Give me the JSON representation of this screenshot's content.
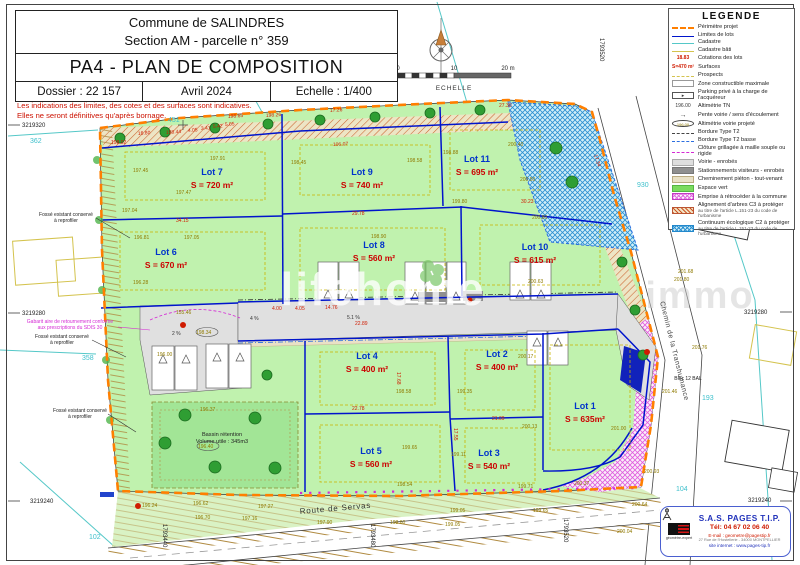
{
  "title_block": {
    "line1": "Commune de SALINDRES",
    "line2": "Section AM - parcelle n° 359",
    "main_title": "PA4 - PLAN DE COMPOSITION",
    "dossier": "Dossier : 22 157",
    "date": "Avril 2024",
    "echelle": "Echelle : 1/400"
  },
  "disclaimer": {
    "line1": "Les indications des limites, des cotes et des surfaces sont indicatives.",
    "line2": "Elles ne seront définitives qu'après bornage."
  },
  "scale_bar": {
    "t0": "0",
    "t10": "10",
    "t20": "20 m",
    "label": "ECHELLE"
  },
  "legend": {
    "title": "LEGENDE",
    "entries": [
      {
        "symbol": "line-orange-dash",
        "label": "Périmètre projet"
      },
      {
        "symbol": "line-blue",
        "label": "Limites de lots"
      },
      {
        "symbol": "line-cyan",
        "label": "Cadastre"
      },
      {
        "symbol": "line-yellow",
        "label": "Cadastre bâti"
      },
      {
        "symbol": "text-red",
        "sample": "18.83",
        "label": "Cotations des lots"
      },
      {
        "symbol": "text-red",
        "sample": "S=470 m²",
        "label": "Surfaces"
      },
      {
        "symbol": "line-yellow-thin",
        "label": "Prospects"
      },
      {
        "symbol": "box-white",
        "label": "Zone constructible maximale"
      },
      {
        "symbol": "box-parking",
        "sample": "▸",
        "label": "Parking privé à la charge de l'acquéreur"
      },
      {
        "symbol": "text-black",
        "sample": "196.00",
        "label": "Altimétrie TN"
      },
      {
        "symbol": "arrow",
        "sample": "→",
        "label": "Pente voirie / sens d'écoulement"
      },
      {
        "symbol": "ellipse",
        "sample": "196.00",
        "label": "Altimétrie voirie projeté"
      },
      {
        "symbol": "line-dark-dash",
        "label": "Bordure Type T2"
      },
      {
        "symbol": "line-blue-dash",
        "label": "Bordure Type T2 basse"
      },
      {
        "symbol": "line-magenta",
        "label": "Clôture grillagée à maille souple ou rigide"
      },
      {
        "symbol": "box-gray-light",
        "label": "Voirie - enrobés"
      },
      {
        "symbol": "box-gray-dark",
        "label": "Stationnements visiteurs - enrobés"
      },
      {
        "symbol": "box-beige",
        "label": "Cheminement piéton - tout-venant"
      },
      {
        "symbol": "box-green",
        "label": "Espace vert"
      },
      {
        "symbol": "hatch-magenta",
        "label": "Emprise à rétrocéder à la commune"
      },
      {
        "symbol": "hatch-red",
        "label": "Alignement d'arbres C3 à protéger",
        "sub": "au titre de l'article L.151-23 du code de l'urbanisme"
      },
      {
        "symbol": "hatch-blue",
        "label": "Continuum écologique C2 à protéger",
        "sub": "au titre de l'article L.151-23 du code de l'urbanisme"
      }
    ]
  },
  "lots": [
    {
      "name": "Lot 1",
      "area": "S = 635m²",
      "x": 585,
      "y": 409
    },
    {
      "name": "Lot 2",
      "area": "S = 400 m²",
      "x": 497,
      "y": 357
    },
    {
      "name": "Lot 3",
      "area": "S = 540 m²",
      "x": 489,
      "y": 456
    },
    {
      "name": "Lot 4",
      "area": "S = 400 m²",
      "x": 367,
      "y": 359
    },
    {
      "name": "Lot 5",
      "area": "S = 560 m²",
      "x": 371,
      "y": 454
    },
    {
      "name": "Lot 6",
      "area": "S = 670 m²",
      "x": 166,
      "y": 255
    },
    {
      "name": "Lot 7",
      "area": "S = 720 m²",
      "x": 212,
      "y": 175
    },
    {
      "name": "Lot 8",
      "area": "S = 560 m²",
      "x": 374,
      "y": 248
    },
    {
      "name": "Lot 9",
      "area": "S = 740 m²",
      "x": 362,
      "y": 175
    },
    {
      "name": "Lot 10",
      "area": "S = 615 m²",
      "x": 535,
      "y": 250
    },
    {
      "name": "Lot 11",
      "area": "S = 695 m²",
      "x": 477,
      "y": 162
    }
  ],
  "streets": {
    "servas": "Route de Servas",
    "transhumance": "Chemin de la Transhumance"
  },
  "basin": {
    "line1": "Bassin rétention",
    "line2": "Volume utile : 345m3"
  },
  "watermark": {
    "main": "lifehome",
    "secondary": "immo"
  },
  "notes": [
    {
      "l1": "Fossé existant conservé",
      "l2": "à reprofiler",
      "x": 66,
      "y": 216,
      "c": "k"
    },
    {
      "l1": "Gabarit aire de retournement conforme",
      "l2": "aux prescriptions du SDIS 30",
      "x": 70,
      "y": 323,
      "c": "m"
    },
    {
      "l1": "Fossé existant conservé",
      "l2": "à reprofiler",
      "x": 62,
      "y": 338,
      "c": "k"
    },
    {
      "l1": "Fossé existant conservé",
      "l2": "à reprofiler",
      "x": 80,
      "y": 412,
      "c": "k"
    },
    {
      "l1": "Bloc 12 BAL",
      "l2": "",
      "x": 688,
      "y": 380,
      "c": "k"
    }
  ],
  "parcels": [
    [
      "362",
      30,
      143
    ],
    [
      "451",
      168,
      122
    ],
    [
      "930",
      637,
      187
    ],
    [
      "358",
      82,
      360
    ],
    [
      "193",
      702,
      400
    ],
    [
      "104",
      676,
      491
    ],
    [
      "102",
      89,
      539
    ]
  ],
  "coordinates": [
    [
      "3219320",
      22,
      127,
      0
    ],
    [
      "3219280",
      22,
      315,
      0
    ],
    [
      "3219240",
      30,
      503,
      0
    ],
    [
      "3219280",
      744,
      314,
      0
    ],
    [
      "3219240",
      748,
      502,
      0
    ],
    [
      "1793520",
      600,
      38,
      90
    ],
    [
      "1793440",
      163,
      524,
      90
    ],
    [
      "1793480",
      371,
      524,
      90
    ],
    [
      "1793520",
      564,
      519,
      90
    ]
  ],
  "annotation_colors": {
    "o": "#8f7a00",
    "r": "#cf1b00",
    "k": "#333333",
    "c": "#3fc0cc",
    "m": "#d429d4"
  },
  "annotations": [
    [
      "198.02",
      111,
      144,
      "r"
    ],
    [
      "16.80",
      138,
      135,
      "r",
      -4
    ],
    [
      "198.44",
      166,
      134,
      "r",
      -4
    ],
    [
      "4.05",
      188,
      132,
      "r",
      -4
    ],
    [
      "3.41",
      201,
      130,
      "r",
      -4
    ],
    [
      "5.42",
      213,
      128,
      "r",
      -4
    ],
    [
      "5.05",
      225,
      126,
      "r",
      -4
    ],
    [
      "198.65",
      228,
      118,
      "r",
      -4
    ],
    [
      "198.26",
      266,
      117,
      "r",
      -4
    ],
    [
      "17.26",
      330,
      112,
      "r",
      -4
    ],
    [
      "106.07",
      333,
      146,
      "r",
      -3
    ],
    [
      "27.30",
      499,
      107,
      "r"
    ],
    [
      "17.34",
      594,
      155,
      "r",
      72
    ],
    [
      "34.15",
      176,
      222,
      "r"
    ],
    [
      "29.78",
      352,
      215,
      "r"
    ],
    [
      "30.23",
      521,
      203,
      "r"
    ],
    [
      "22.78",
      352,
      410,
      "r"
    ],
    [
      "21.09",
      492,
      420,
      "r"
    ],
    [
      "4.00",
      272,
      310,
      "r"
    ],
    [
      "4.05",
      295,
      310,
      "r"
    ],
    [
      "14.76",
      325,
      309,
      "r"
    ],
    [
      "22.89",
      355,
      325,
      "r"
    ],
    [
      "17.68",
      397,
      372,
      "r",
      90
    ],
    [
      "17.55",
      454,
      428,
      "r",
      90
    ],
    [
      "197.45",
      133,
      172,
      "o"
    ],
    [
      "197.91",
      210,
      160,
      "o"
    ],
    [
      "197.47",
      176,
      194,
      "o"
    ],
    [
      "197.04",
      122,
      212,
      "o"
    ],
    [
      "196.81",
      134,
      239,
      "o"
    ],
    [
      "197.05",
      184,
      239,
      "o"
    ],
    [
      "196.28",
      133,
      284,
      "o"
    ],
    [
      "198.45",
      291,
      164,
      "o"
    ],
    [
      "198.58",
      407,
      162,
      "o"
    ],
    [
      "198.88",
      443,
      154,
      "o"
    ],
    [
      "200.40",
      508,
      146,
      "o"
    ],
    [
      "200.50",
      520,
      181,
      "o"
    ],
    [
      "199.80",
      452,
      203,
      "o"
    ],
    [
      "198.90",
      371,
      238,
      "o"
    ],
    [
      "200.80",
      532,
      219,
      "o"
    ],
    [
      "200.63",
      528,
      283,
      "o"
    ],
    [
      "200.17",
      518,
      358,
      "o"
    ],
    [
      "199.35",
      457,
      393,
      "o"
    ],
    [
      "198.58",
      396,
      393,
      "o"
    ],
    [
      "200.13",
      522,
      428,
      "o"
    ],
    [
      "199.65",
      402,
      449,
      "o"
    ],
    [
      "199.11",
      451,
      456,
      "o"
    ],
    [
      "198.54",
      397,
      486,
      "o"
    ],
    [
      "199.71",
      518,
      488,
      "o"
    ],
    [
      "201.76",
      692,
      349,
      "o"
    ],
    [
      "201.46",
      662,
      393,
      "o"
    ],
    [
      "201.00",
      611,
      430,
      "o"
    ],
    [
      "200.93",
      644,
      473,
      "o"
    ],
    [
      "200.37",
      574,
      485,
      "o"
    ],
    [
      "200.64",
      632,
      506,
      "o"
    ],
    [
      "196.37",
      200,
      411,
      "o"
    ],
    [
      "196.24",
      142,
      507,
      "o"
    ],
    [
      "196.62",
      193,
      505,
      "o"
    ],
    [
      "197.27",
      258,
      508,
      "o"
    ],
    [
      "196.70",
      195,
      519,
      "o"
    ],
    [
      "197.16",
      242,
      520,
      "o"
    ],
    [
      "197.90",
      317,
      524,
      "o"
    ],
    [
      "199.05",
      450,
      512,
      "o"
    ],
    [
      "199.65",
      533,
      512,
      "o"
    ],
    [
      "198.60",
      390,
      524,
      "o"
    ],
    [
      "199.05",
      445,
      526,
      "o"
    ],
    [
      "200.04",
      617,
      533,
      "o"
    ],
    [
      "198.34",
      196,
      334,
      "o"
    ],
    [
      "196.00",
      157,
      356,
      "o"
    ],
    [
      "196.40",
      198,
      448,
      "o"
    ],
    [
      "201.68",
      678,
      273,
      "o"
    ],
    [
      "201.80",
      674,
      281,
      "o"
    ],
    [
      "155.46",
      176,
      314,
      "o"
    ],
    [
      "2 %",
      172,
      335,
      "k"
    ],
    [
      "4 %",
      250,
      320,
      "k"
    ],
    [
      "5.1 %",
      347,
      319,
      "k"
    ]
  ],
  "company": {
    "name": "S.A.S. PAGES T.I.P.",
    "tel": "Tél: 04 67 02 06 40",
    "email": "E-mail : geometre@pagestip.fr",
    "address": "27 Rue de l'Hostellerie - 34000 MONTPELLIER",
    "web": "site internet : www.pages-tip.fr",
    "logo_caption": "géomètre-expert"
  }
}
